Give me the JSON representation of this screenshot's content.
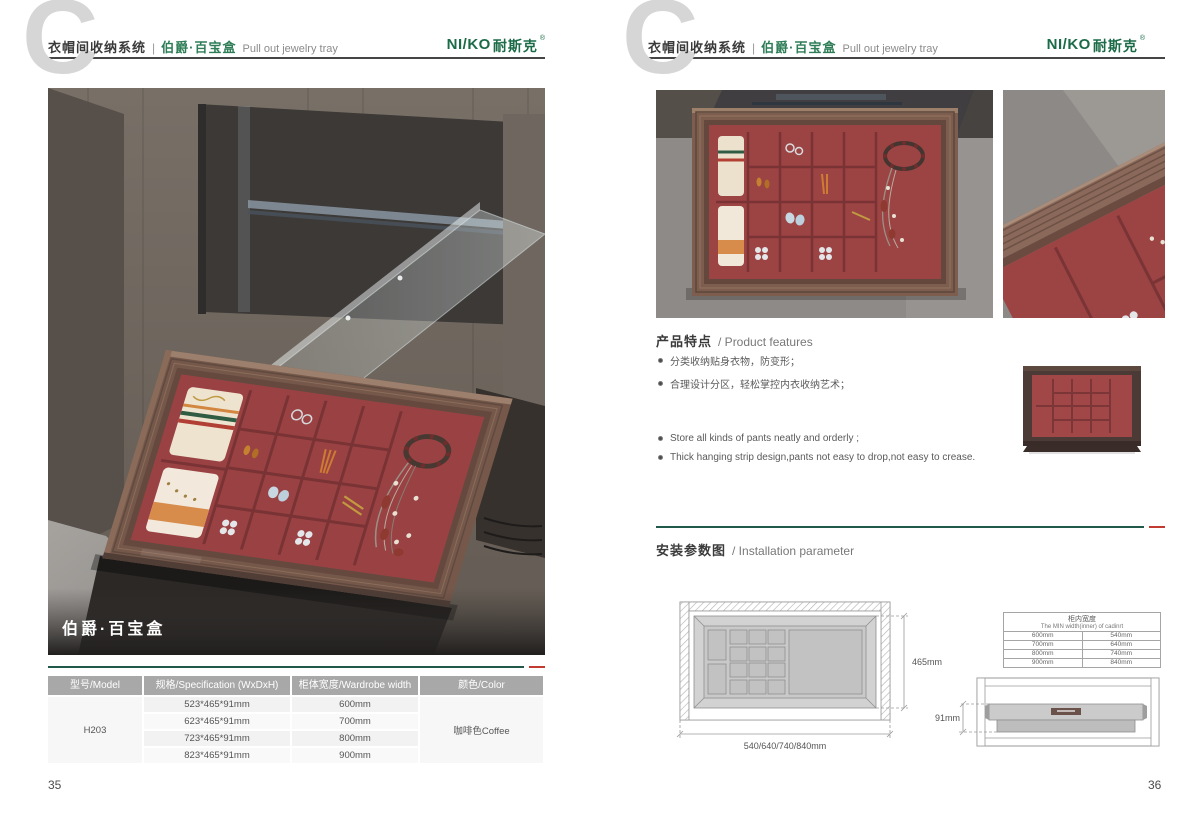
{
  "colors": {
    "brand_green": "#1C6B47",
    "divider_green": "#20594A",
    "divider_red": "#C23B30",
    "velvet_red": "#9C4344",
    "frame_brown": "#7A5A4C",
    "table_header_gray": "#A8A8A8"
  },
  "header": {
    "watermark": "C",
    "system_title_cn": "衣帽间收纳系统",
    "separator": "|",
    "product_name_cn": "伯爵·百宝盒",
    "product_name_en": "Pull out jewelry tray"
  },
  "brand": {
    "logo_en": "NI/KO",
    "logo_cn": "耐斯克",
    "registered_mark": "®"
  },
  "left_page": {
    "page_number": "35",
    "photo_caption": "伯爵·百宝盒",
    "spec_table": {
      "headers": {
        "model": "型号/Model",
        "spec": "规格/Specification (WxDxH)",
        "width": "柜体宽度/Wardrobe width",
        "color": "颜色/Color"
      },
      "model": "H203",
      "color": "咖啡色Coffee",
      "rows": [
        {
          "spec": "523*465*91mm",
          "width": "600mm"
        },
        {
          "spec": "623*465*91mm",
          "width": "700mm"
        },
        {
          "spec": "723*465*91mm",
          "width": "800mm"
        },
        {
          "spec": "823*465*91mm",
          "width": "900mm"
        }
      ]
    }
  },
  "right_page": {
    "page_number": "36",
    "features": {
      "title_cn": "产品特点",
      "title_en": "/ Product features",
      "bullets_cn": [
        "分类收纳贴身衣物，防变形；",
        "合理设计分区，轻松掌控内衣收纳艺术；"
      ],
      "bullets_en": [
        "Store all kinds of pants neatly and orderly ;",
        "Thick hanging strip design,pants not easy to drop,not easy to crease."
      ]
    },
    "installation": {
      "title_cn": "安装参数图",
      "title_en": "/ Installation parameter",
      "top_view": {
        "depth_label": "465mm",
        "width_label": "540/640/740/840mm"
      },
      "cabinet_width_table": {
        "title_cn": "柜内宽度",
        "title_en": "The MIN width(inner) of cadinrt",
        "rows": [
          [
            "600mm",
            "540mm"
          ],
          [
            "700mm",
            "640mm"
          ],
          [
            "800mm",
            "740mm"
          ],
          [
            "900mm",
            "840mm"
          ]
        ]
      },
      "side_view": {
        "height_label": "91mm"
      }
    }
  }
}
